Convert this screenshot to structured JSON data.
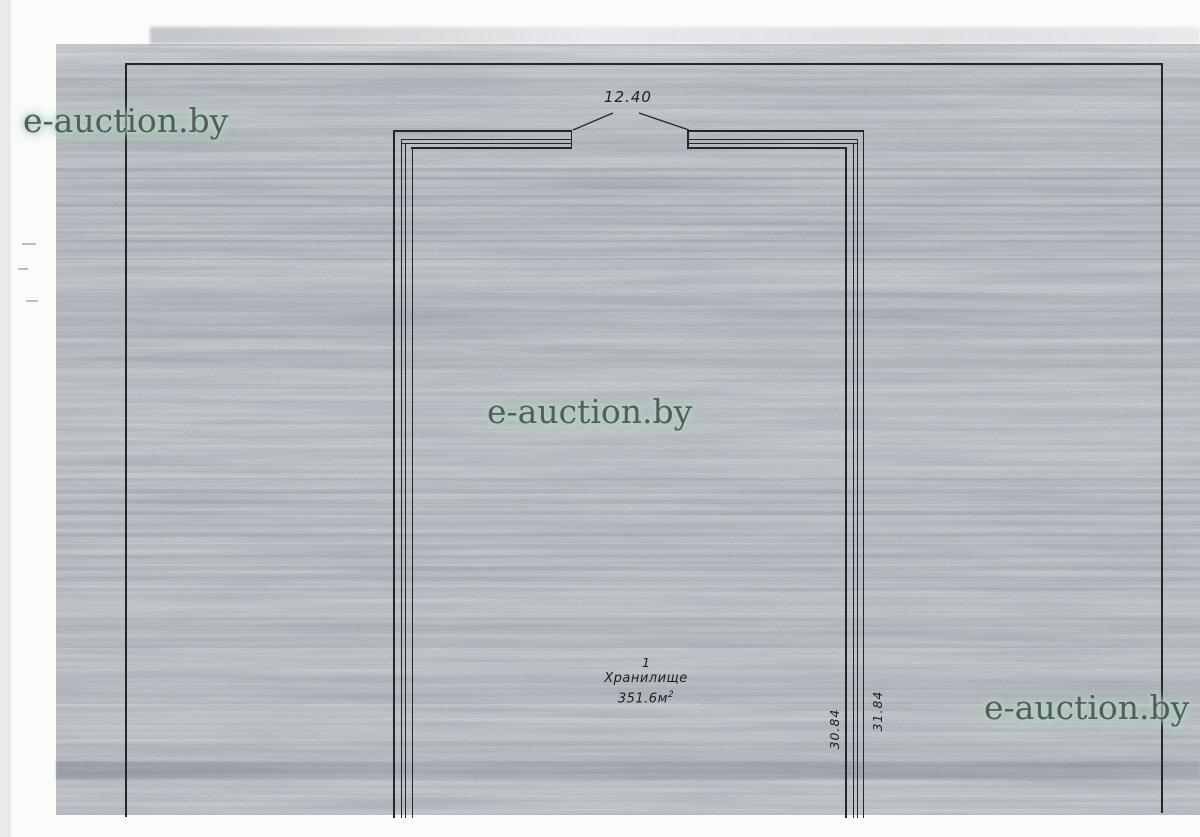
{
  "watermark": {
    "text": "e-auction.by",
    "text_color": "#575c5b",
    "glow_color": "#b3d6c4"
  },
  "dimensions": {
    "opening_width": "12.40",
    "wall_inner_height": "30.84",
    "wall_outer_height": "31.84"
  },
  "room": {
    "number": "1",
    "name": "Хранилище",
    "area": "351.6м",
    "area_sup": "2"
  },
  "colors": {
    "ink": "#26262a",
    "paper": "#d2d5d9"
  }
}
